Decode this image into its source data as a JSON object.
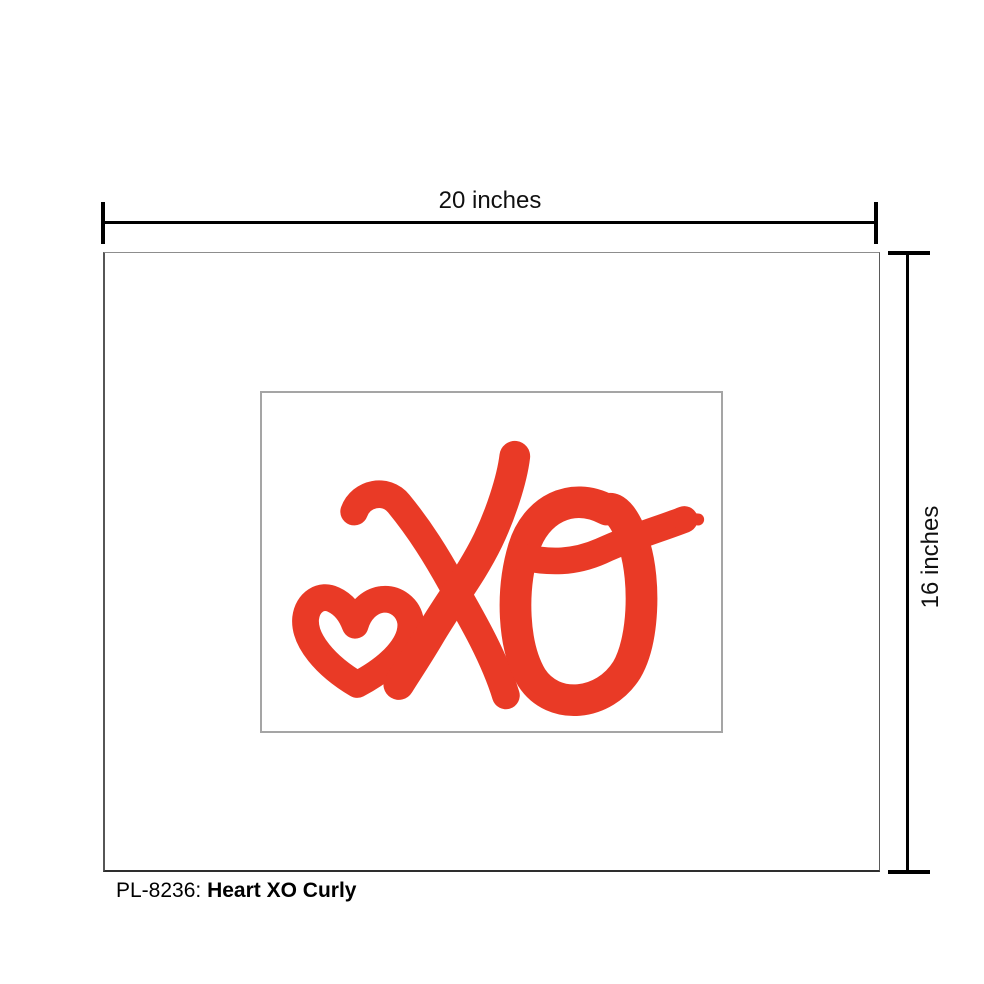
{
  "product": {
    "sku_label": "PL-8236:",
    "title": "Heart XO Curly"
  },
  "dimensions": {
    "width_label": "20 inches",
    "height_label": "16 inches"
  },
  "art": {
    "description": "Hand-painted red heart with cursive XO brush strokes",
    "red": "#E93A26"
  },
  "colors": {
    "dimension_lines": "#000000",
    "label_text": "#101010",
    "print_border": "#565656",
    "opening_border": "#A5A5A5",
    "background": "#FFFFFF"
  }
}
